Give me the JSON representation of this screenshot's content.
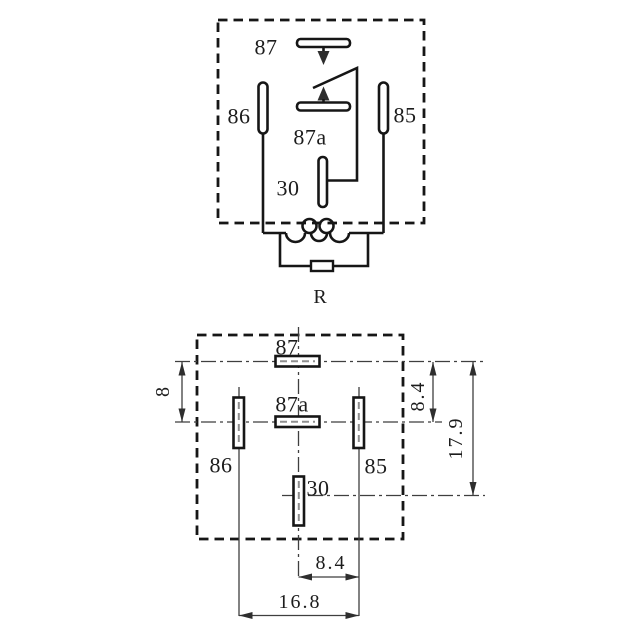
{
  "colors": {
    "background": "#ffffff",
    "line": "#161616",
    "thin_line": "#3f3f3f",
    "text": "#1c1c1c"
  },
  "schematic": {
    "labels": {
      "pin87": "87",
      "pin86": "86",
      "pin85": "85",
      "pin87a": "87a",
      "pin30": "30",
      "resistor": "R"
    }
  },
  "footprint": {
    "labels": {
      "pin87": "87",
      "pin87a": "87a",
      "pin86": "86",
      "pin85": "85",
      "pin30": "30"
    },
    "dimensions": {
      "row_offset_left": "8",
      "row_offset_right": "8.4",
      "total_height": "17.9",
      "pin_half_spacing": "8.4",
      "pin_full_spacing": "16.8"
    }
  }
}
